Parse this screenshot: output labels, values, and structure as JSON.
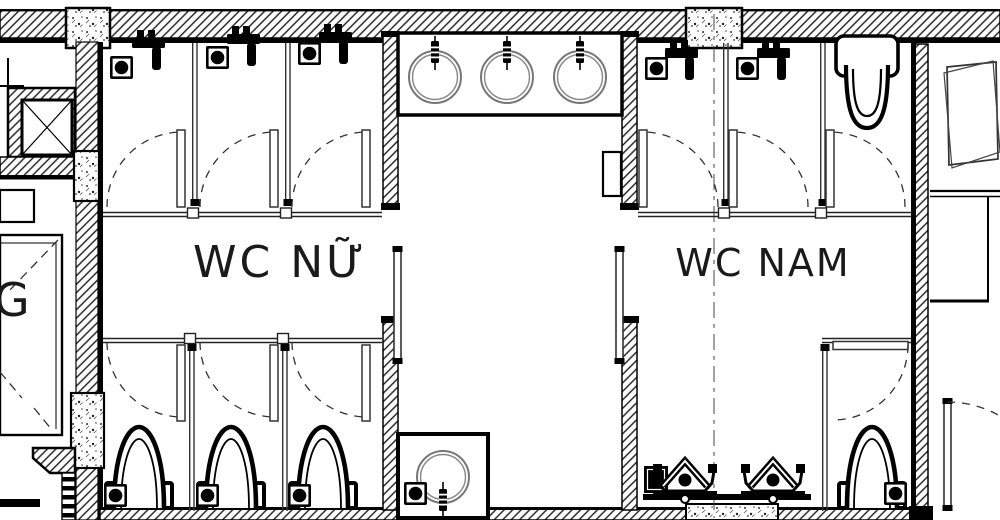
{
  "colors": {
    "ink": "#000000",
    "line": "#333333",
    "basin_line": "#777777",
    "background": "#ffffff"
  },
  "floor_plan": {
    "type": "architectural floor plan — public restroom block",
    "wc_nu": {
      "label": "WC NỮ",
      "spray_stalls": 3,
      "toilet_stalls": 3
    },
    "wc_nam": {
      "label": "WC NAM",
      "spray_stalls": 2,
      "toilets": 2,
      "urinals": 2
    },
    "adjacent_room_label": "G",
    "shared": {
      "wash_basins": 3,
      "mop_basin": 1,
      "floor_drains": 10,
      "spray_guns": 5
    },
    "symbols": [
      "wall-hatch",
      "concrete-column",
      "shaft-x-symbol",
      "door-swing-arc",
      "floor-drain-icon",
      "spray-gun-icon",
      "wash-basin-icon",
      "toilet-icon",
      "wall-hung-toilet-icon",
      "urinal-icon"
    ]
  }
}
